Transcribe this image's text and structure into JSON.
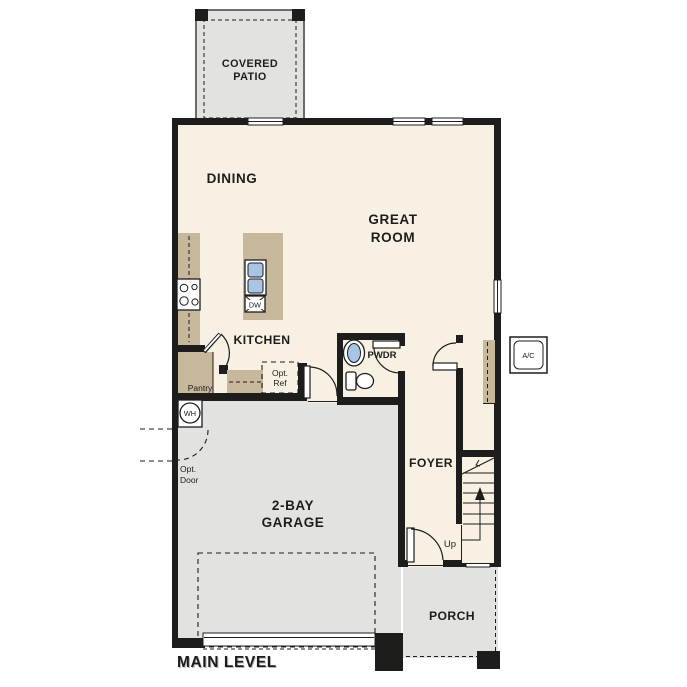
{
  "plan": {
    "title": "MAIN LEVEL"
  },
  "colors": {
    "floor": "#f8f1e3",
    "outdoor": "#e2e2e0",
    "counter": "#c7b89b",
    "fixture_blue": "#a9c5e5",
    "wall": "#1d1d1b"
  },
  "rooms": {
    "covered_patio": {
      "line1": "COVERED",
      "line2": "PATIO"
    },
    "dining": {
      "label": "DINING"
    },
    "great_room": {
      "line1": "GREAT",
      "line2": "ROOM"
    },
    "kitchen": {
      "label": "KITCHEN"
    },
    "pantry": {
      "label": "Pantry"
    },
    "powder": {
      "label": "PWDR"
    },
    "foyer": {
      "label": "FOYER"
    },
    "garage": {
      "line1": "2-BAY",
      "line2": "GARAGE"
    },
    "porch": {
      "label": "PORCH"
    }
  },
  "annotations": {
    "opt_ref": {
      "line1": "Opt.",
      "line2": "Ref"
    },
    "opt_door": {
      "line1": "Opt.",
      "line2": "Door"
    },
    "water_heater": "WH",
    "dishwasher": "DW",
    "ac_unit": "A/C",
    "stairs_up": "Up"
  }
}
